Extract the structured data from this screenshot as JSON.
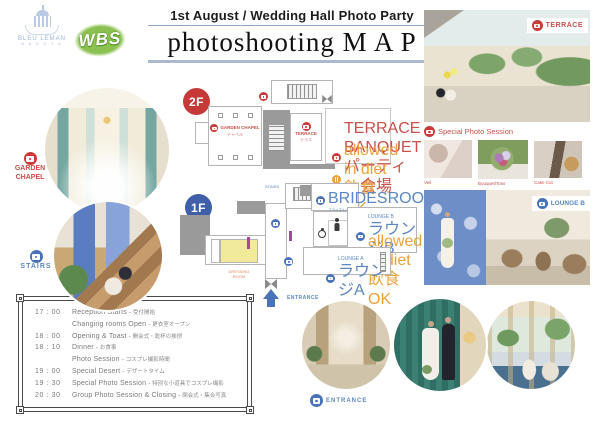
{
  "header": {
    "brand": {
      "name": "BLEU LEMAN",
      "sub": "N A G O Y A"
    },
    "partner_logo": "WBS",
    "subtitle": "1st August / Wedding Hall Photo Party",
    "title": "photoshooting M A P"
  },
  "left": {
    "garden_chapel": {
      "line1": "GARDEN",
      "line2": "CHAPEL"
    },
    "stairs": "STAIRS"
  },
  "map2f": {
    "badge": "2F",
    "garden_chapel": {
      "en": "GARDEN CHAPEL",
      "jp": "チャペル"
    },
    "terrace": {
      "en": "TERRACE",
      "jp": "テラス"
    },
    "banquet": {
      "en": "TERRACE BANQUET",
      "jp": "パーティー会場"
    },
    "allowed": {
      "en": "allowed in diet",
      "jp": "飲食OK"
    }
  },
  "map1f": {
    "badge": "1F",
    "stairs": "STAIRS",
    "bridesroom": {
      "en": "BRIDESROOM",
      "jp": "ブライズルーム"
    },
    "lounge_b": {
      "en": "LOUNGE B",
      "jp": "ラウンジB"
    },
    "allowed": {
      "en": "allowed in diet",
      "jp": "飲食OK"
    },
    "lounge_a": {
      "en": "LOUNGE A",
      "jp": "ラウンジA"
    },
    "dressing": {
      "line1": "DRESSING",
      "line2": "ROOM"
    },
    "entrance": "ENTRANCE"
  },
  "right": {
    "terrace_label": "TERRACE",
    "special_session": "Special Photo Session",
    "thumbs": [
      {
        "label": "Veil"
      },
      {
        "label": "Bouquet/Toss"
      },
      {
        "label": "Cake Cut"
      }
    ],
    "lounge_b_label": "LOUNGE B"
  },
  "bottom": {
    "entrance_label": "ENTRANCE"
  },
  "schedule": {
    "sep": "-",
    "rows": [
      {
        "time": "17 : 00",
        "en": "Reception Starts",
        "jp": "受付開始"
      },
      {
        "time": "",
        "en": "Changing rooms Open",
        "jp": "更衣室オープン"
      },
      {
        "time": "18 : 00",
        "en": "Opening & Toast",
        "jp": "開会式・乾杯の挨拶"
      },
      {
        "time": "18 : 10",
        "en": "Dinner",
        "jp": "お食事"
      },
      {
        "time": "",
        "en": "Photo Session",
        "jp": "コスプレ撮影時間"
      },
      {
        "time": "19 : 00",
        "en": "Special Desert",
        "jp": "デザートタイム"
      },
      {
        "time": "19 : 30",
        "en": "Special Photo Session",
        "jp": "特別な小道具でコスプレ撮影"
      },
      {
        "time": "20 : 30",
        "en": "Group Photo Session & Closing",
        "jp": "閉会式・集合写真"
      }
    ]
  },
  "colors": {
    "red": "#c93b38",
    "blue_badge": "#3f5fa8",
    "label_blue": "#5b87c5",
    "orange": "#eaa33c"
  }
}
